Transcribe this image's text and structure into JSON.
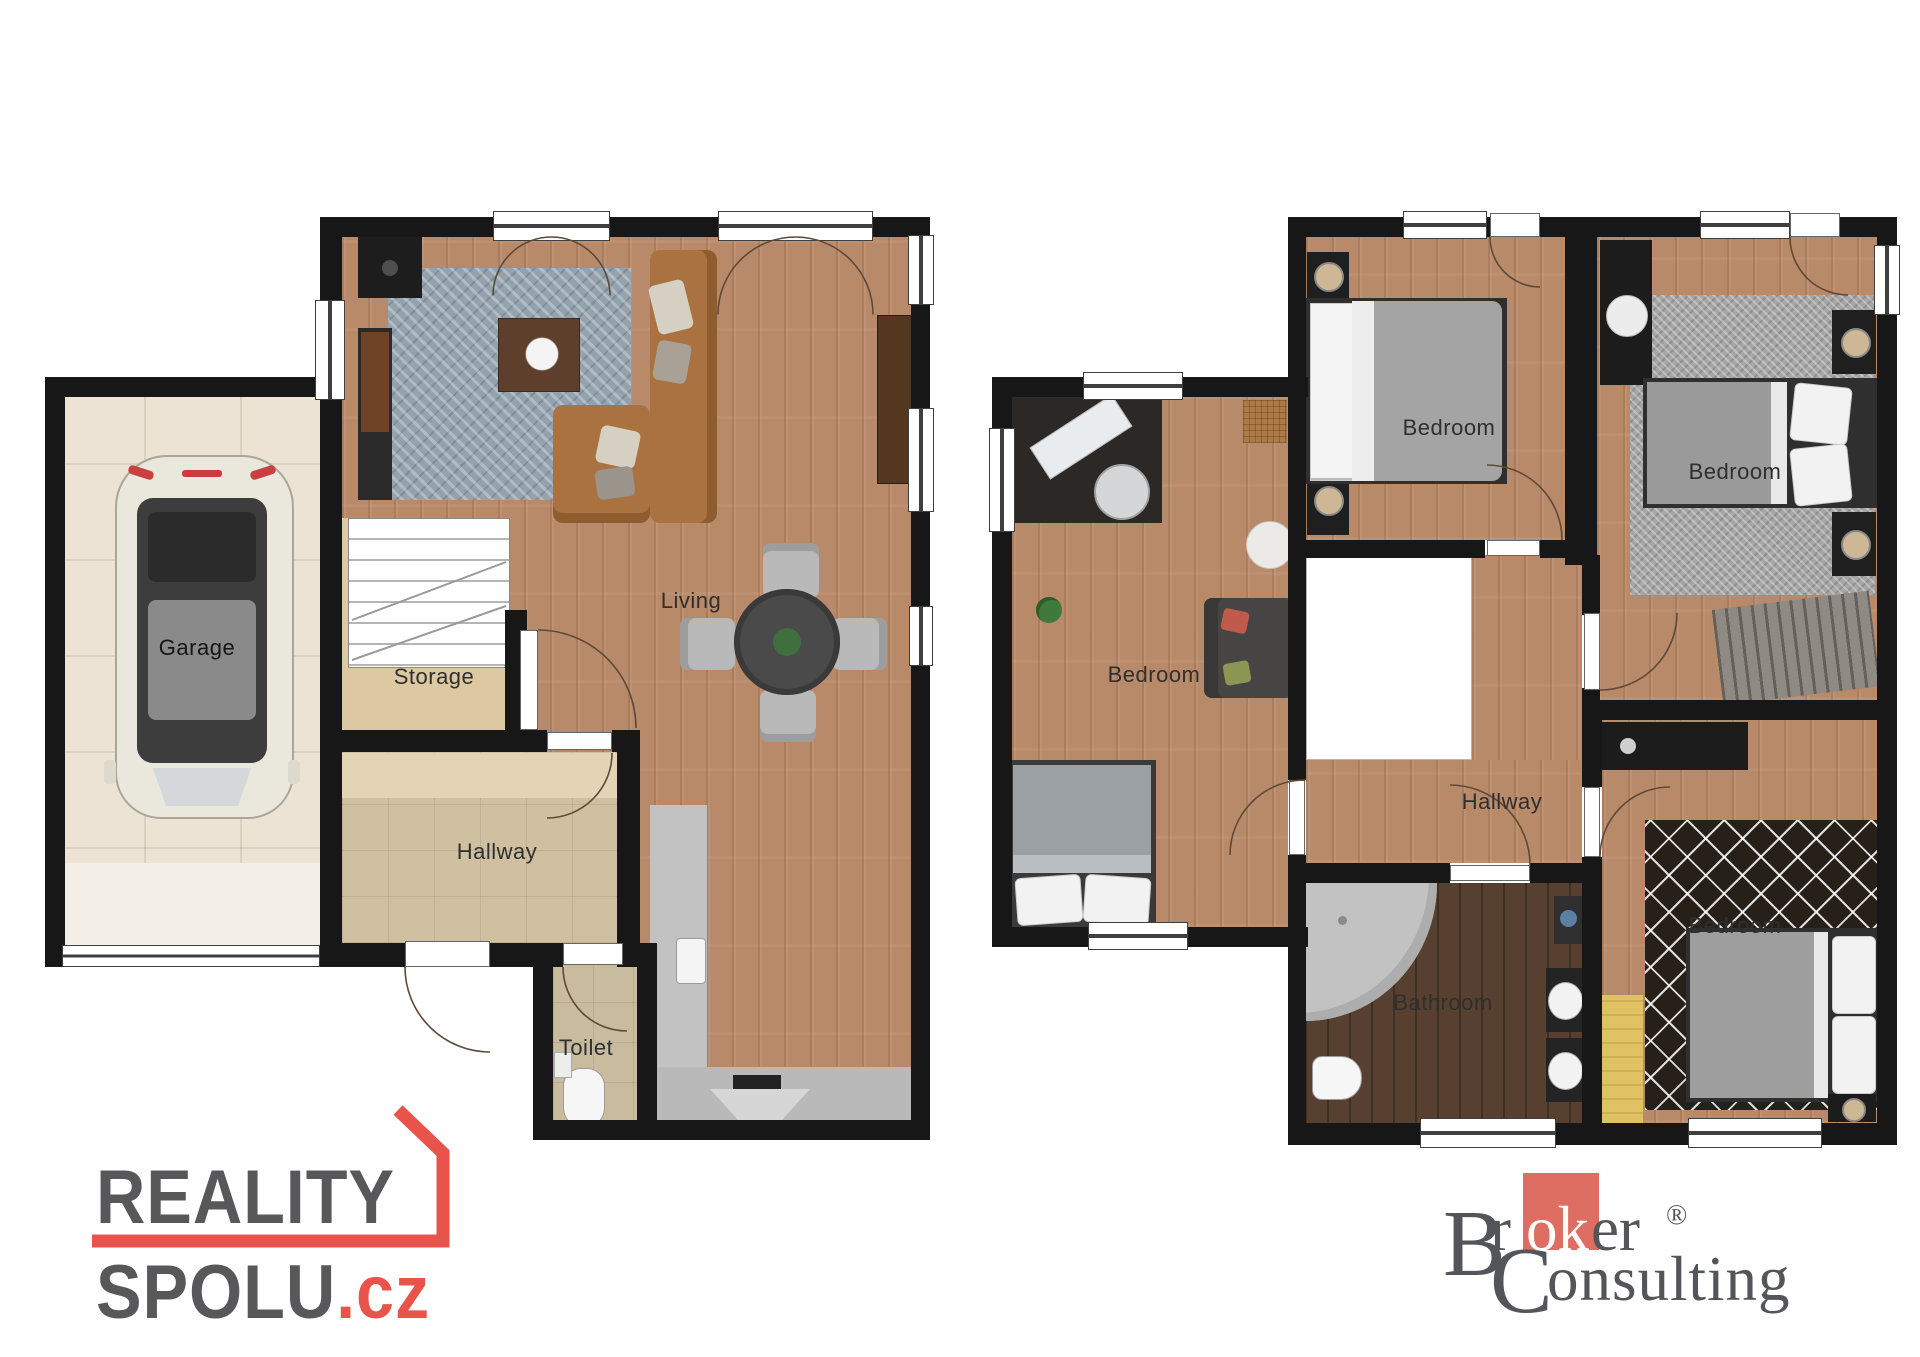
{
  "document": {
    "type": "real-estate floor plan sheet",
    "background": "#ffffff"
  },
  "rooms": [
    {
      "label": "Garage"
    },
    {
      "label": "Storage"
    },
    {
      "label": "Living"
    },
    {
      "label": "Hallway"
    },
    {
      "label": "Toilet"
    },
    {
      "label": "Bedroom"
    },
    {
      "label": "Bedroom"
    },
    {
      "label": "Bedroom"
    },
    {
      "label": "Bedroom"
    },
    {
      "label": "Hallway"
    },
    {
      "label": "Bathroom"
    }
  ],
  "logos": {
    "reality_spolu": {
      "line1": "REALITY",
      "line2": "SPOLU",
      "suffix": ".cz",
      "text_color": "#58585a",
      "accent_color": "#e8544c"
    },
    "broker_consulting": {
      "initial1": "B",
      "r1": "r",
      "ok": "ok",
      "er": "er",
      "reg": "®",
      "initial2": "C",
      "rest2": "onsulting",
      "text_color": "#54555a",
      "accent_color": "#dd6e61"
    }
  },
  "palette": {
    "wall": "#171717",
    "wood_floor": "#b98a69",
    "dark_wood_floor": "#57402f",
    "garage_tile": "#ece3d4",
    "hall_tile": "#cfc0a1",
    "living_rug": "#93a2ad",
    "sofa_leather": "#aa7240",
    "yellow_mat": "#e0c264"
  }
}
